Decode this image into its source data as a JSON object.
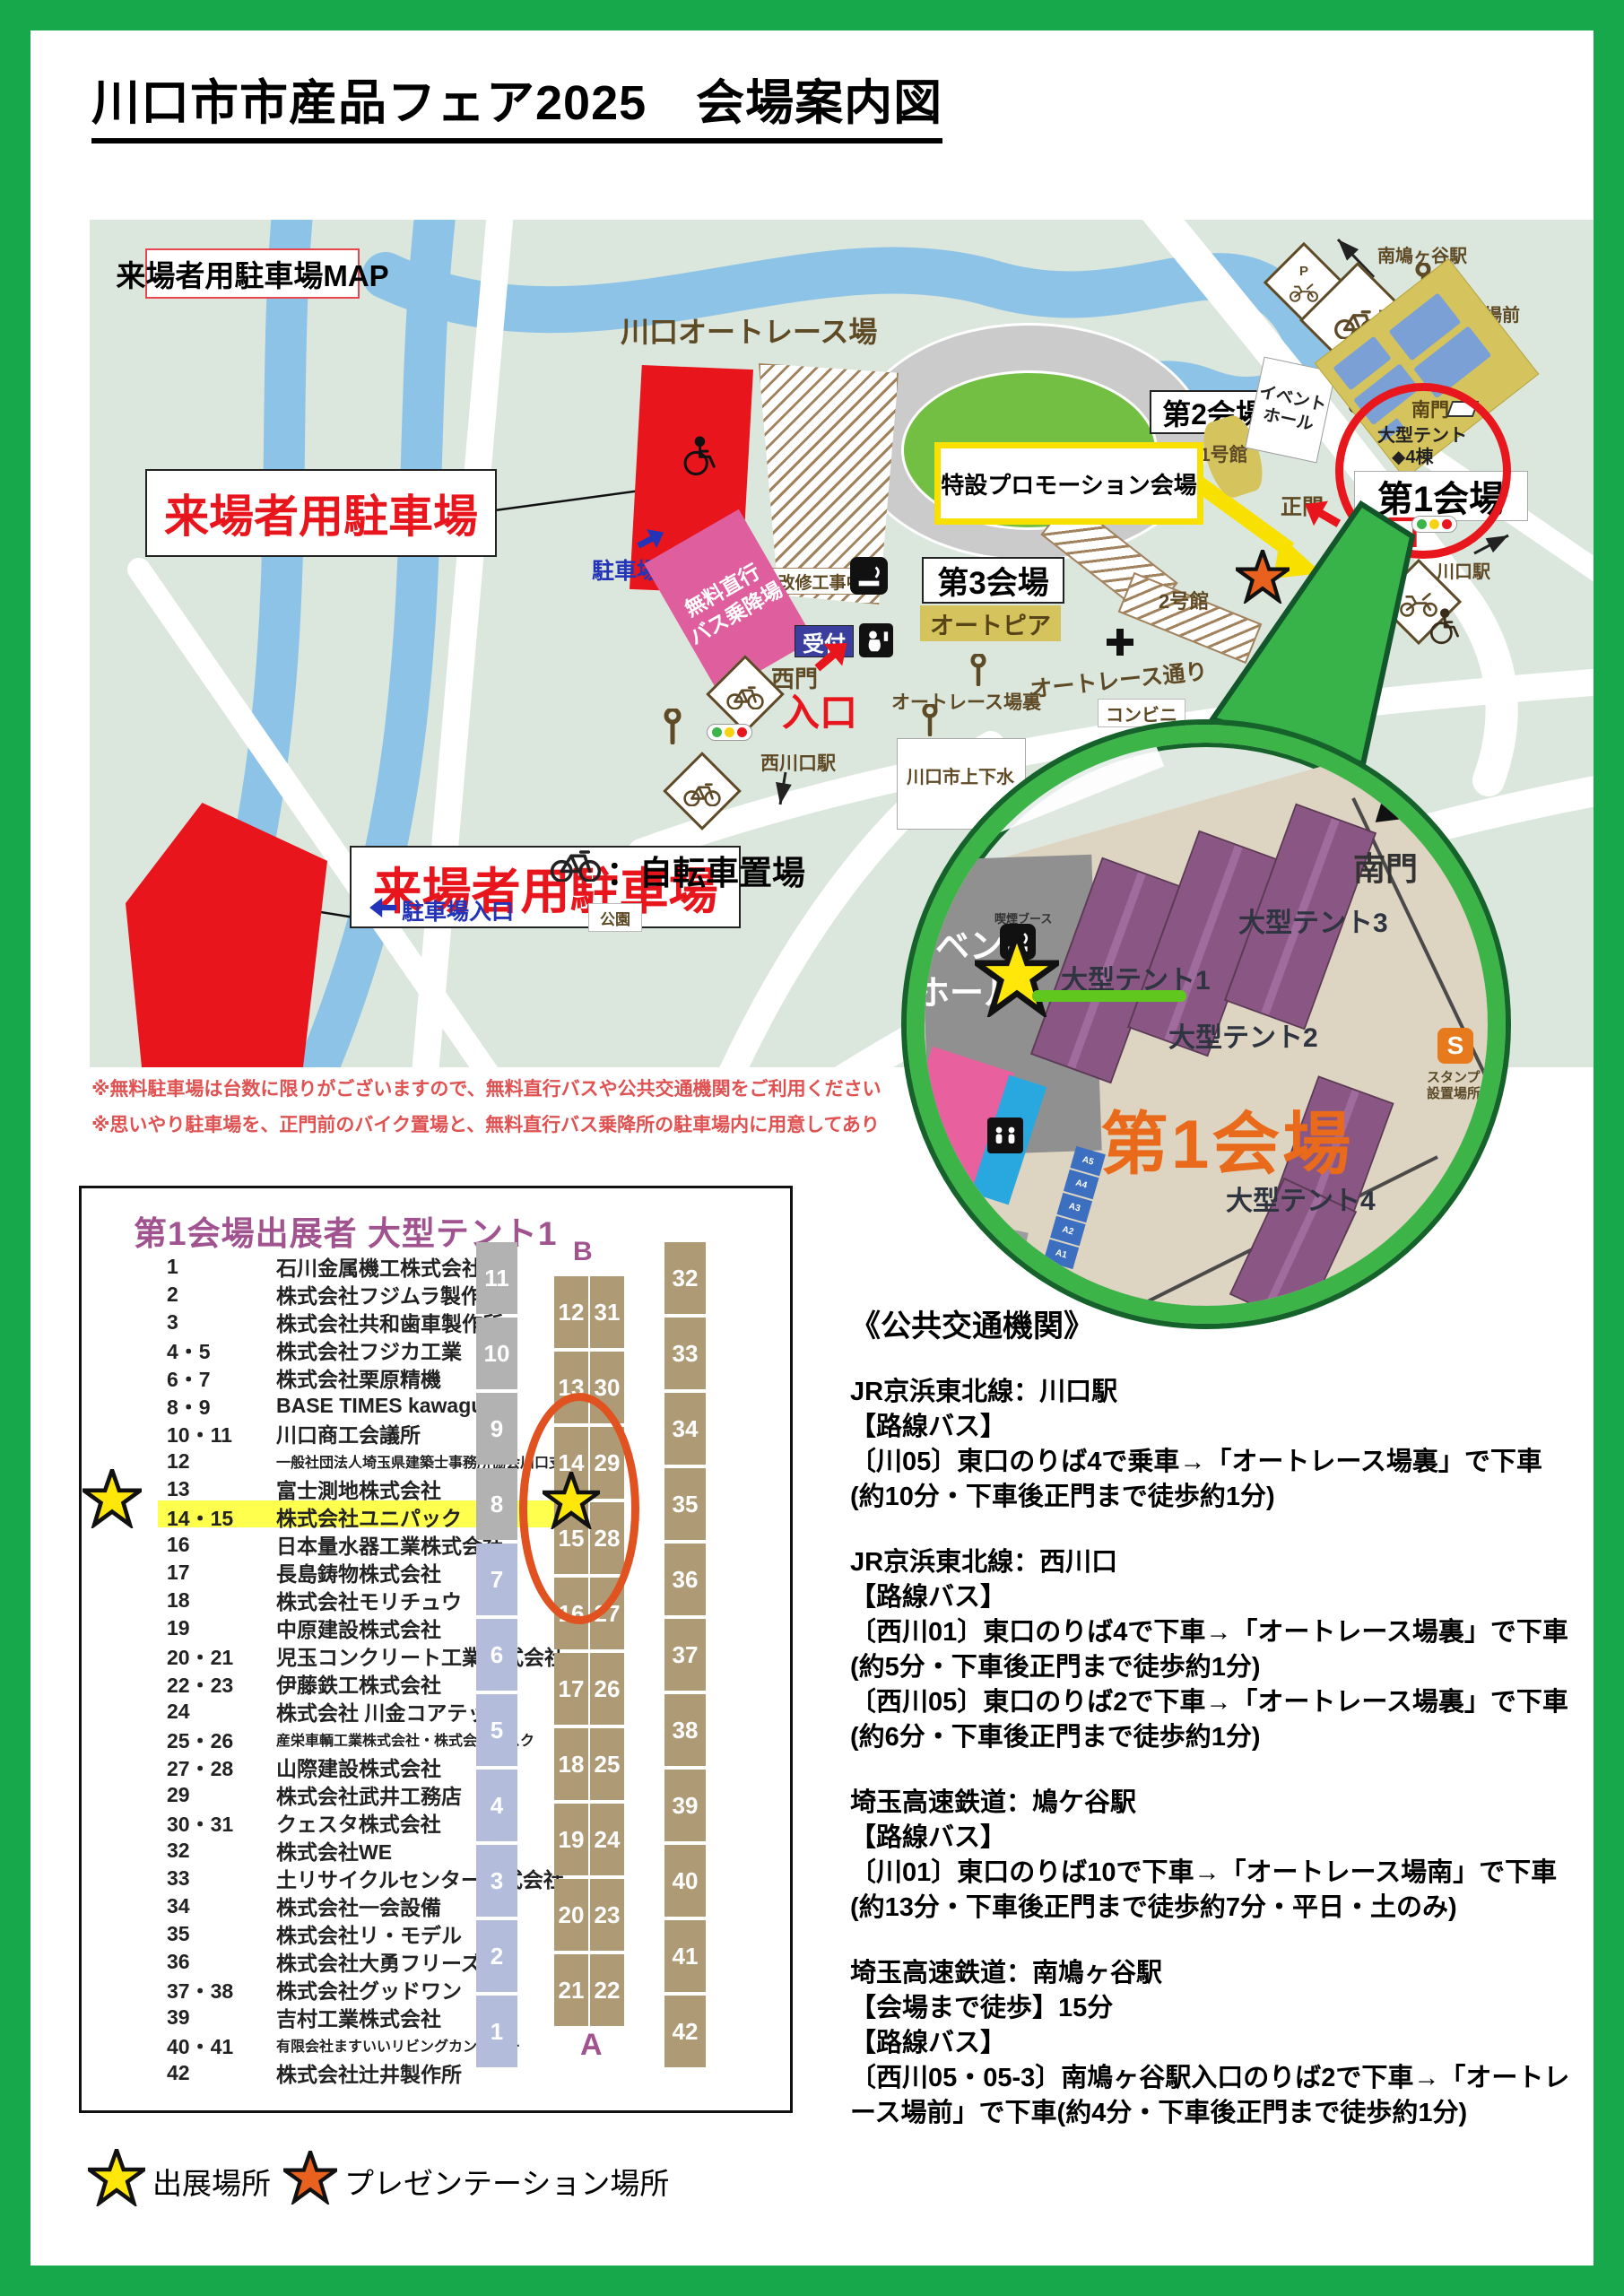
{
  "page": {
    "title": "川口市市産品フェア2025　会場案内図"
  },
  "map": {
    "parking_map_title": "来場者用駐車場MAP",
    "autorace_track": "川口オートレース場",
    "construction": "改修工事中",
    "visitor_parking_1": "来場者用駐車場",
    "visitor_parking_2": "来場者用駐車場",
    "parking_entrance_1": "駐車場入口",
    "parking_entrance_2": "駐車場入口",
    "free_bus_l1": "無料直行",
    "free_bus_l2": "バス乗降場",
    "promo_venue": "特設プロモーション会場",
    "venue1": "第1会場",
    "venue2": "第2会場",
    "venue3": "第3会場",
    "autopia": "オートピア",
    "hall1": "1号館",
    "hall2": "2号館",
    "event_hall_l1": "イベント",
    "event_hall_l2": "ホール",
    "reception_1": "受付",
    "reception_2": "受付",
    "south_gate": "南門",
    "west_gate": "西門",
    "main_gate": "正門",
    "entrance_1": "入口",
    "entrance_2": "入口",
    "entrance_3": "入口",
    "tent4_l1": "大型テント",
    "tent4_l2": "◆4棟",
    "sta_minamihatogaya": "南鳩ヶ谷駅",
    "bus_autorace_mae": "オートレース場前",
    "bus_autorace_ura": "オートレース場裏",
    "autorace_street": "オートレース通り",
    "conbini": "コンビニ",
    "sta_nishikawaguchi": "西川口駅",
    "sta_kawaguchi": "川口駅",
    "waterworks": "川口市上下水",
    "park": "公園",
    "p_sign": "P",
    "bicycle_legend": "：自転車置場",
    "note1": "※無料駐車場は台数に限りがございますので、無料直行バスや公共交通機関をご利用ください",
    "note2": "※思いやり駐車場を、正門前のバイク置場と、無料直行バス乗降所の駐車場内に用意してあり"
  },
  "inset": {
    "venue1": "第1会場",
    "south_gate": "南門",
    "tent1": "大型テント1",
    "tent2": "大型テント2",
    "tent3": "大型テント3",
    "tent4": "大型テント4",
    "event_l1": "イベント",
    "event_l2": "ホール",
    "smoking_booth": "喫煙ブース",
    "stamp_s": "S",
    "stamp_l1": "スタンプ",
    "stamp_l2": "設置場所",
    "booths": [
      "A5",
      "A4",
      "A3",
      "A2",
      "A1"
    ]
  },
  "exhibitors": {
    "title": "第1会場出展者 大型テント1",
    "rows": [
      {
        "no": "1",
        "name": "石川金属機工株式会社"
      },
      {
        "no": "2",
        "name": "株式会社フジムラ製作所"
      },
      {
        "no": "3",
        "name": "株式会社共和歯車製作所"
      },
      {
        "no": "4・5",
        "name": "株式会社フジカ工業"
      },
      {
        "no": "6・7",
        "name": "株式会社栗原精機"
      },
      {
        "no": "8・9",
        "name": "BASE TIMES kawaguchi"
      },
      {
        "no": "10・11",
        "name": "川口商工会議所"
      },
      {
        "no": "12",
        "name": "一般社団法人埼玉県建築士事務所協会川口支部"
      },
      {
        "no": "13",
        "name": "富士測地株式会社"
      },
      {
        "no": "14・15",
        "name": "株式会社ユニパック"
      },
      {
        "no": "16",
        "name": "日本量水器工業株式会社"
      },
      {
        "no": "17",
        "name": "長島鋳物株式会社"
      },
      {
        "no": "18",
        "name": "株式会社モリチュウ"
      },
      {
        "no": "19",
        "name": "中原建設株式会社"
      },
      {
        "no": "20・21",
        "name": "児玉コンクリート工業株式会社"
      },
      {
        "no": "22・23",
        "name": "伊藤鉄工株式会社"
      },
      {
        "no": "24",
        "name": "株式会社 川金コアテック"
      },
      {
        "no": "25・26",
        "name": "産栄車輌工業株式会社・株式会社アスク"
      },
      {
        "no": "27・28",
        "name": "山際建設株式会社"
      },
      {
        "no": "29",
        "name": "株式会社武井工務店"
      },
      {
        "no": "30・31",
        "name": "クェスタ株式会社"
      },
      {
        "no": "32",
        "name": "株式会社WE"
      },
      {
        "no": "33",
        "name": "土リサイクルセンター株式会社"
      },
      {
        "no": "34",
        "name": "株式会社一会設備"
      },
      {
        "no": "35",
        "name": "株式会社リ・モデル"
      },
      {
        "no": "36",
        "name": "株式会社大勇フリーズ"
      },
      {
        "no": "37・38",
        "name": "株式会社グッドワン"
      },
      {
        "no": "39",
        "name": "吉村工業株式会社"
      },
      {
        "no": "40・41",
        "name": "有限会社ますいいリビングカンパニー"
      },
      {
        "no": "42",
        "name": "株式会社辻井製作所"
      }
    ]
  },
  "diagram": {
    "b": "B",
    "a": "A",
    "left": [
      "11",
      "10",
      "9",
      "8",
      "7",
      "6",
      "5",
      "4",
      "3",
      "2",
      "1"
    ],
    "center_left": [
      "12",
      "13",
      "14",
      "15",
      "16",
      "17",
      "18",
      "19",
      "20",
      "21"
    ],
    "center_right": [
      "31",
      "30",
      "29",
      "28",
      "27",
      "26",
      "25",
      "24",
      "23",
      "22"
    ],
    "right": [
      "32",
      "33",
      "34",
      "35",
      "36",
      "37",
      "38",
      "39",
      "40",
      "41",
      "42"
    ]
  },
  "transport": {
    "title": "《公共交通機関》",
    "blocks": [
      {
        "lines": [
          "JR京浜東北線：川口駅",
          "【路線バス】",
          "〔川05〕東口のりば4で乗車→「オートレース場裏」で下車",
          "(約10分・下車後正門まで徒歩約1分)"
        ]
      },
      {
        "lines": [
          "JR京浜東北線：西川口",
          "【路線バス】",
          "〔西川01〕東口のりば4で下車→「オートレース場裏」で下車(約5分・下車後正門まで徒歩約1分)",
          "〔西川05〕東口のりば2で下車→「オートレース場裏」で下車(約6分・下車後正門まで徒歩約1分)"
        ]
      },
      {
        "lines": [
          "埼玉高速鉄道：鳩ケ谷駅",
          "【路線バス】",
          "〔川01〕東口のりば10で下車→「オートレース場南」で下車(約13分・下車後正門まで徒歩約7分・平日・土のみ)"
        ]
      },
      {
        "lines": [
          "埼玉高速鉄道：南鳩ヶ谷駅",
          "【会場まで徒歩】15分",
          "【路線バス】",
          "〔西川05・05-3〕南鳩ヶ谷駅入口のりば2で下車→「オートレース場前」で下車(約4分・下車後正門まで徒歩約1分)"
        ]
      }
    ]
  },
  "legend": {
    "exhibit": "出展場所",
    "presentation": "プレゼンテーション場所"
  },
  "colors": {
    "frame_green": "#17a84b",
    "map_bg": "#dbe6dc",
    "red": "#e8151d",
    "pink": "#df5f9e",
    "navy": "#3a3f9d",
    "khaki": "#d5c35e",
    "purple_header": "#a0538f",
    "tent_purple": "#8a5784",
    "inset_ring": "#3cb447",
    "orange_text": "#e96a1a",
    "tan_cell": "#ae9b75",
    "star_yellow": "#ffe70a",
    "star_orange": "#e8611e"
  }
}
